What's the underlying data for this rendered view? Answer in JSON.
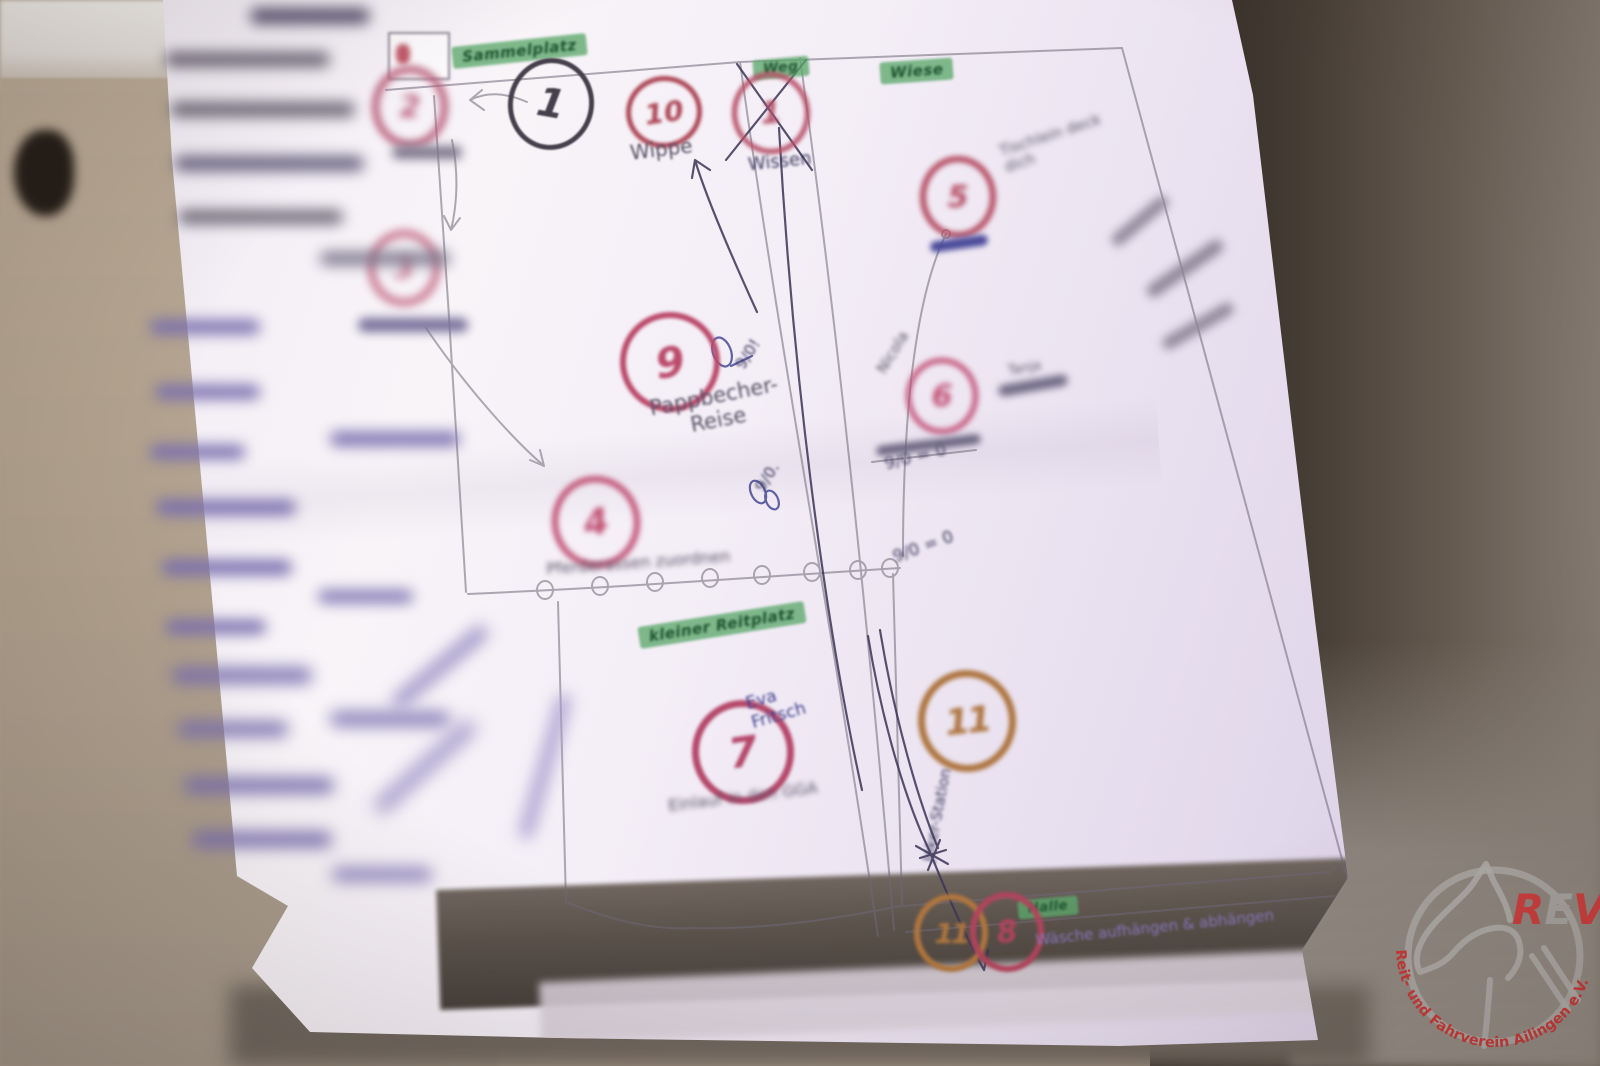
{
  "course_map": {
    "area_labels": {
      "sammelplatz": "Sammelplatz",
      "weg": "Weg",
      "wiese": "Wiese",
      "kleiner_reitplatz": "kleiner Reitplatz",
      "halle": "Halle"
    },
    "stations": {
      "s1": {
        "num": "1"
      },
      "s2": {
        "num": "2"
      },
      "s3": {
        "num": "3"
      },
      "s4": {
        "num": "4",
        "label": "Pferderassen zuordnen"
      },
      "s5": {
        "num": "5",
        "label": "Tischlein deck dich"
      },
      "s6": {
        "num": "6",
        "helper_name": "Nicola",
        "note": "Tanja"
      },
      "s7": {
        "num": "7",
        "label": "Einlauf in den GGA",
        "helper_name": "Eva Fritsch"
      },
      "s8": {
        "num": "8",
        "label": "Wäsche aufhängen & abhängen"
      },
      "s9": {
        "num": "9",
        "label": "Pappbecher-\nReise"
      },
      "s10": {
        "num": "10",
        "label": "Wippe"
      },
      "s1_crossed": {
        "num": "1",
        "label": "Wissen"
      },
      "s11a": {
        "num": "11",
        "label": "Joker-Station"
      },
      "s11b": {
        "num": "11"
      }
    },
    "score_notes": {
      "n1": "9/0!",
      "n2": "9/0.",
      "n3": "9/0 = 0",
      "n4": "9/0 = 0"
    }
  },
  "watermark": {
    "initials": {
      "r": "R",
      "e": "E",
      "v": "V"
    },
    "club_name": "Reit- und Fahrverein Ailingen e.V."
  }
}
